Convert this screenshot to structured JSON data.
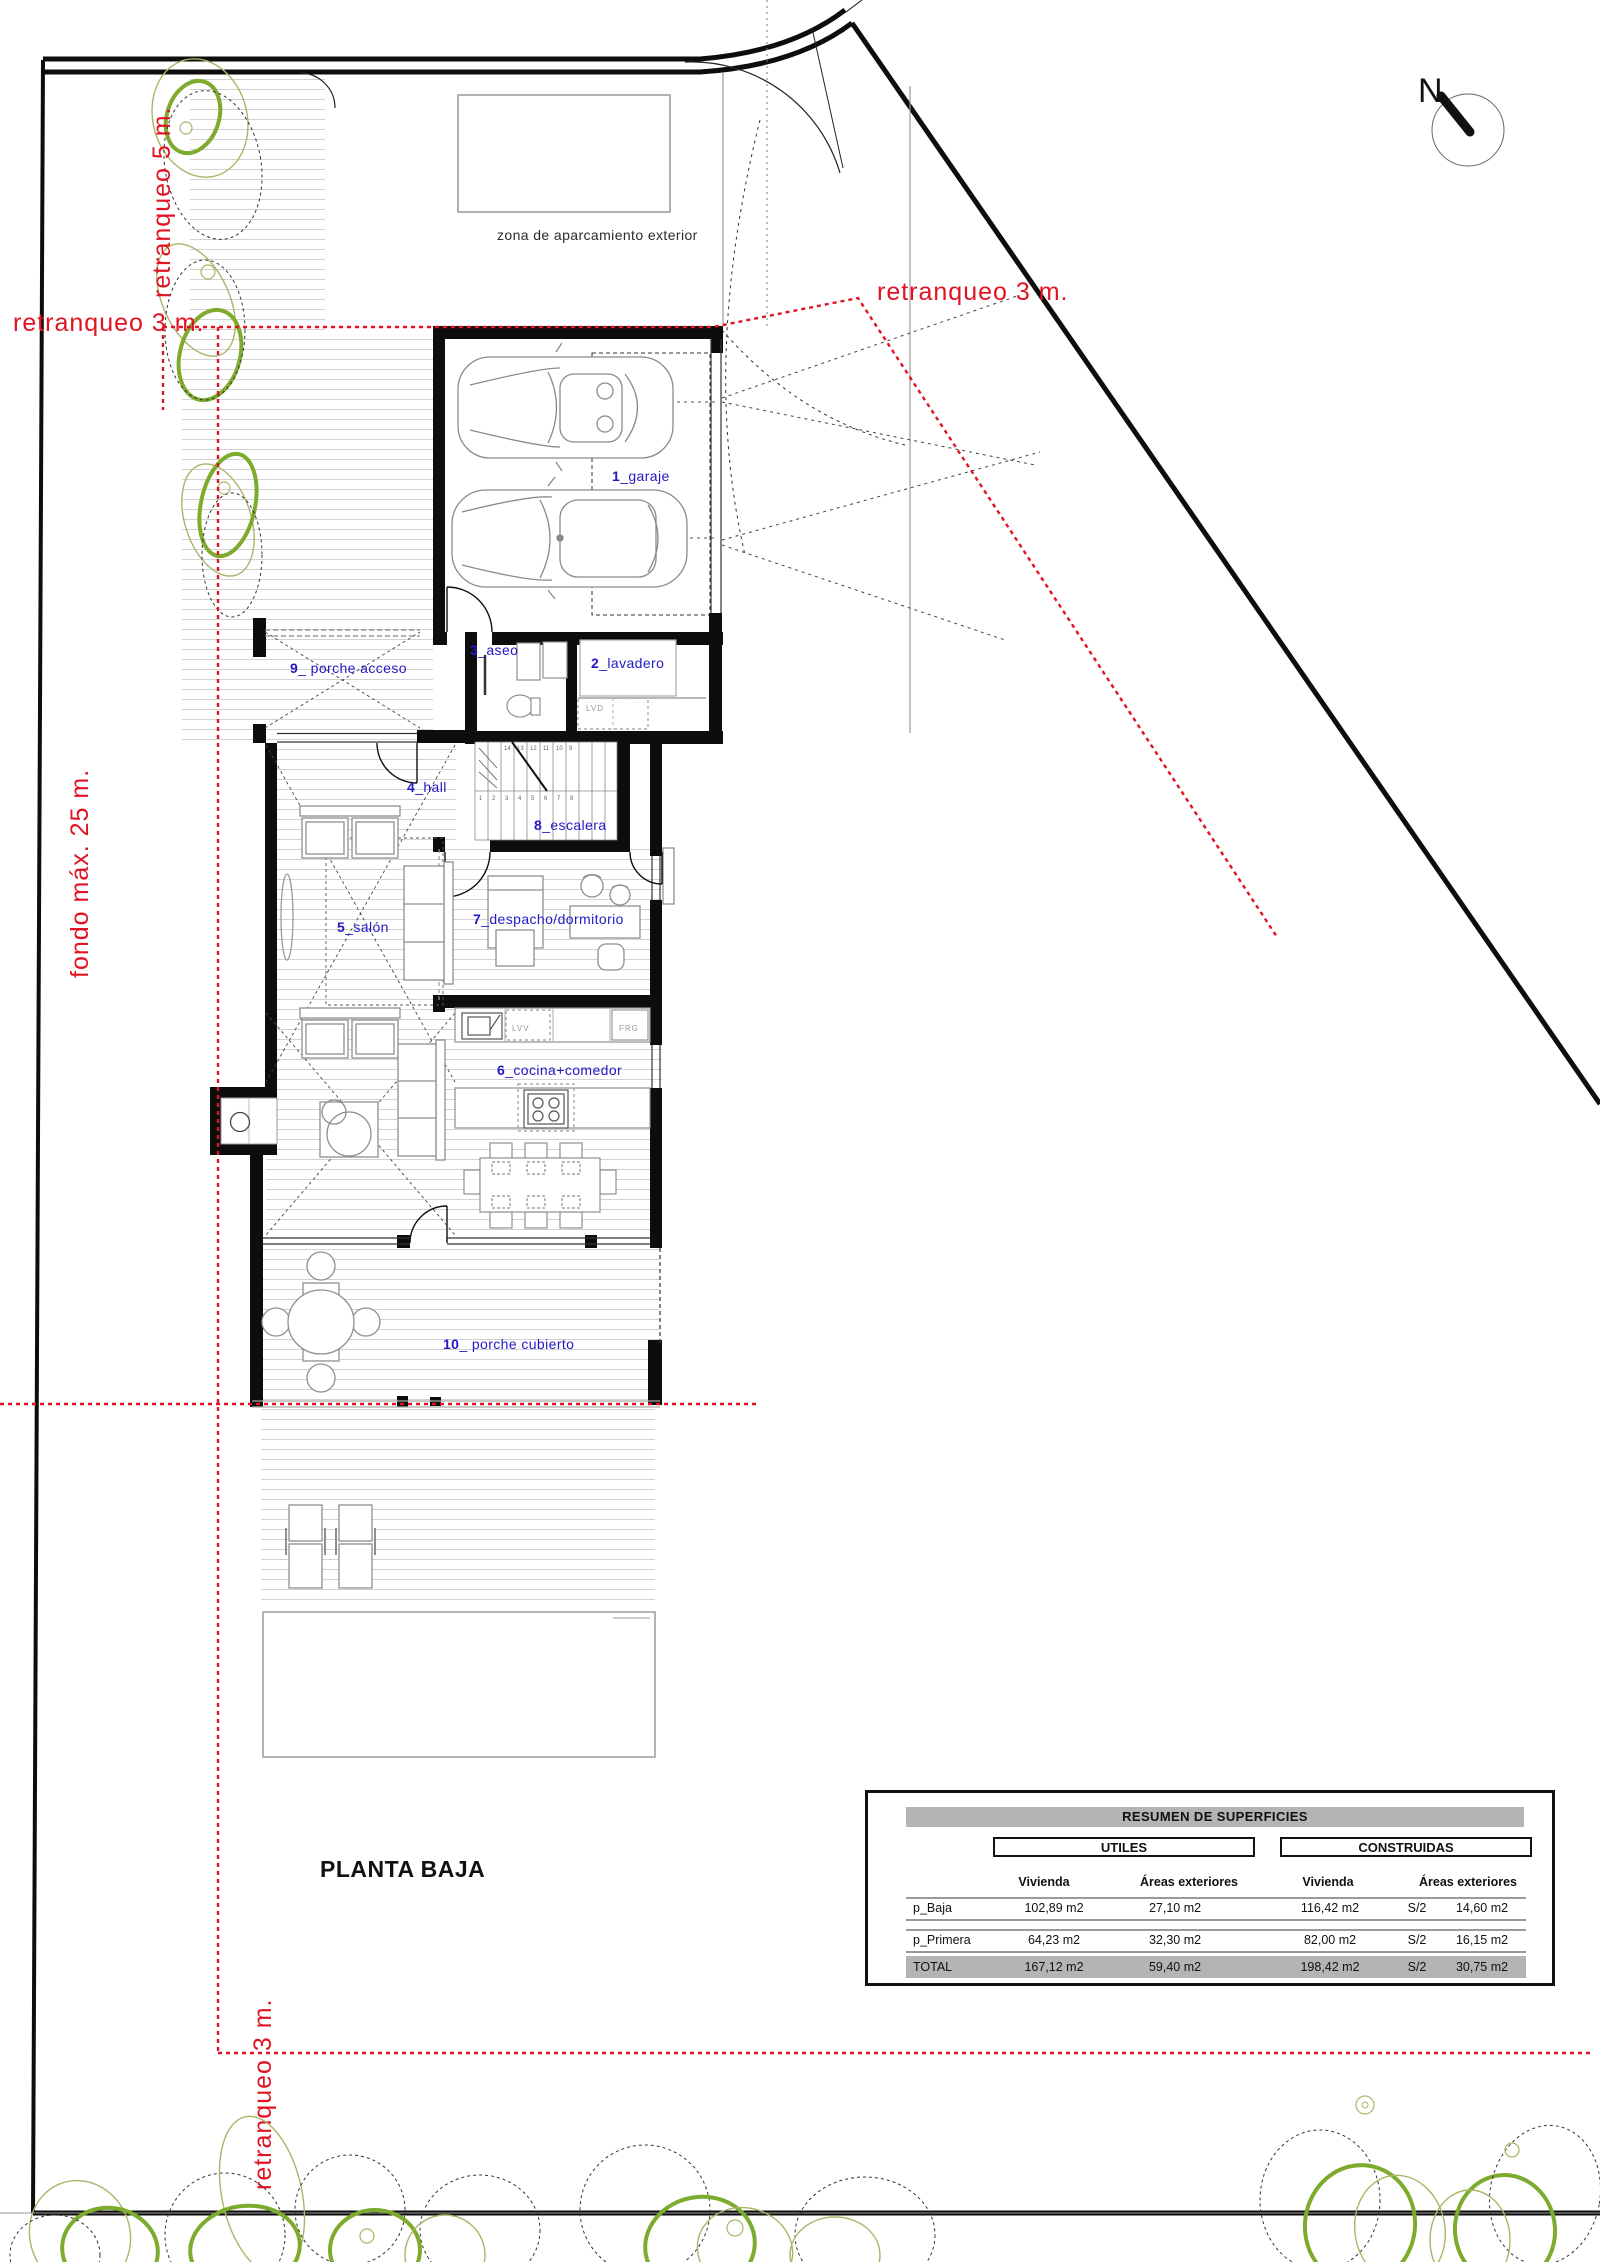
{
  "title": "PLANTA BAJA",
  "north_label": "N",
  "site": {
    "parking_label": "zona de aparcamiento exterior"
  },
  "setbacks": {
    "retranqueo_5m_left": "retranqueo  5 m.",
    "retranqueo_3m_left": "retranqueo  3 m.",
    "retranqueo_3m_right": "retranqueo  3 m.",
    "fondo_max": "fondo máx.  25 m.",
    "retranqueo_3m_bottom": "retranqueo  3 m."
  },
  "rooms": {
    "garaje": {
      "num": "1",
      "rest": "_garaje"
    },
    "lavadero": {
      "num": "2",
      "rest": "_lavadero"
    },
    "aseo": {
      "num": "3",
      "rest": "_aseo"
    },
    "hall": {
      "num": "4",
      "rest": "_hall"
    },
    "salon": {
      "num": "5",
      "rest": "_salón"
    },
    "cocina": {
      "num": "6",
      "rest": "_cocina+comedor"
    },
    "despacho": {
      "num": "7",
      "rest": "_despacho/dormitorio"
    },
    "escalera": {
      "num": "8",
      "rest": "_escalera"
    },
    "porche_acceso": {
      "num": "9",
      "rest": "_ porche acceso"
    },
    "porche_cubierto": {
      "num": "10",
      "rest": "_ porche cubierto"
    }
  },
  "appliances": {
    "dishwasher": "LVV",
    "fridge": "FRG",
    "washer": "LVD"
  },
  "stairs": {
    "numbers_top": [
      "14",
      "13",
      "12",
      "11",
      "10",
      "9"
    ],
    "numbers_bottom": [
      "1",
      "2",
      "3",
      "4",
      "5",
      "6",
      "7",
      "8"
    ]
  },
  "summary_table": {
    "title": "RESUMEN DE SUPERFICIES",
    "group_utiles": "UTILES",
    "group_construidas": "CONSTRUIDAS",
    "col_vivienda": "Vivienda",
    "col_areas": "Áreas exteriores",
    "rows": [
      {
        "name": "p_Baja",
        "utiles_vivienda": "102,89 m2",
        "utiles_areas": "27,10 m2",
        "constr_vivienda": "116,42 m2",
        "s2": "S/2",
        "constr_areas": "14,60 m2"
      },
      {
        "name": "p_Primera",
        "utiles_vivienda": "64,23 m2",
        "utiles_areas": "32,30 m2",
        "constr_vivienda": "82,00 m2",
        "s2": "S/2",
        "constr_areas": "16,15 m2"
      }
    ],
    "total": {
      "name": "TOTAL",
      "utiles_vivienda": "167,12 m2",
      "utiles_areas": "59,40 m2",
      "constr_vivienda": "198,42 m2",
      "s2": "S/2",
      "constr_areas": "30,75 m2"
    }
  },
  "colors": {
    "setback_red": "#e01323",
    "room_label_blue": "#2319c4",
    "tree_green": "#7cab2d",
    "tree_olive": "#aab567",
    "wall_black": "#0d0d0d"
  }
}
